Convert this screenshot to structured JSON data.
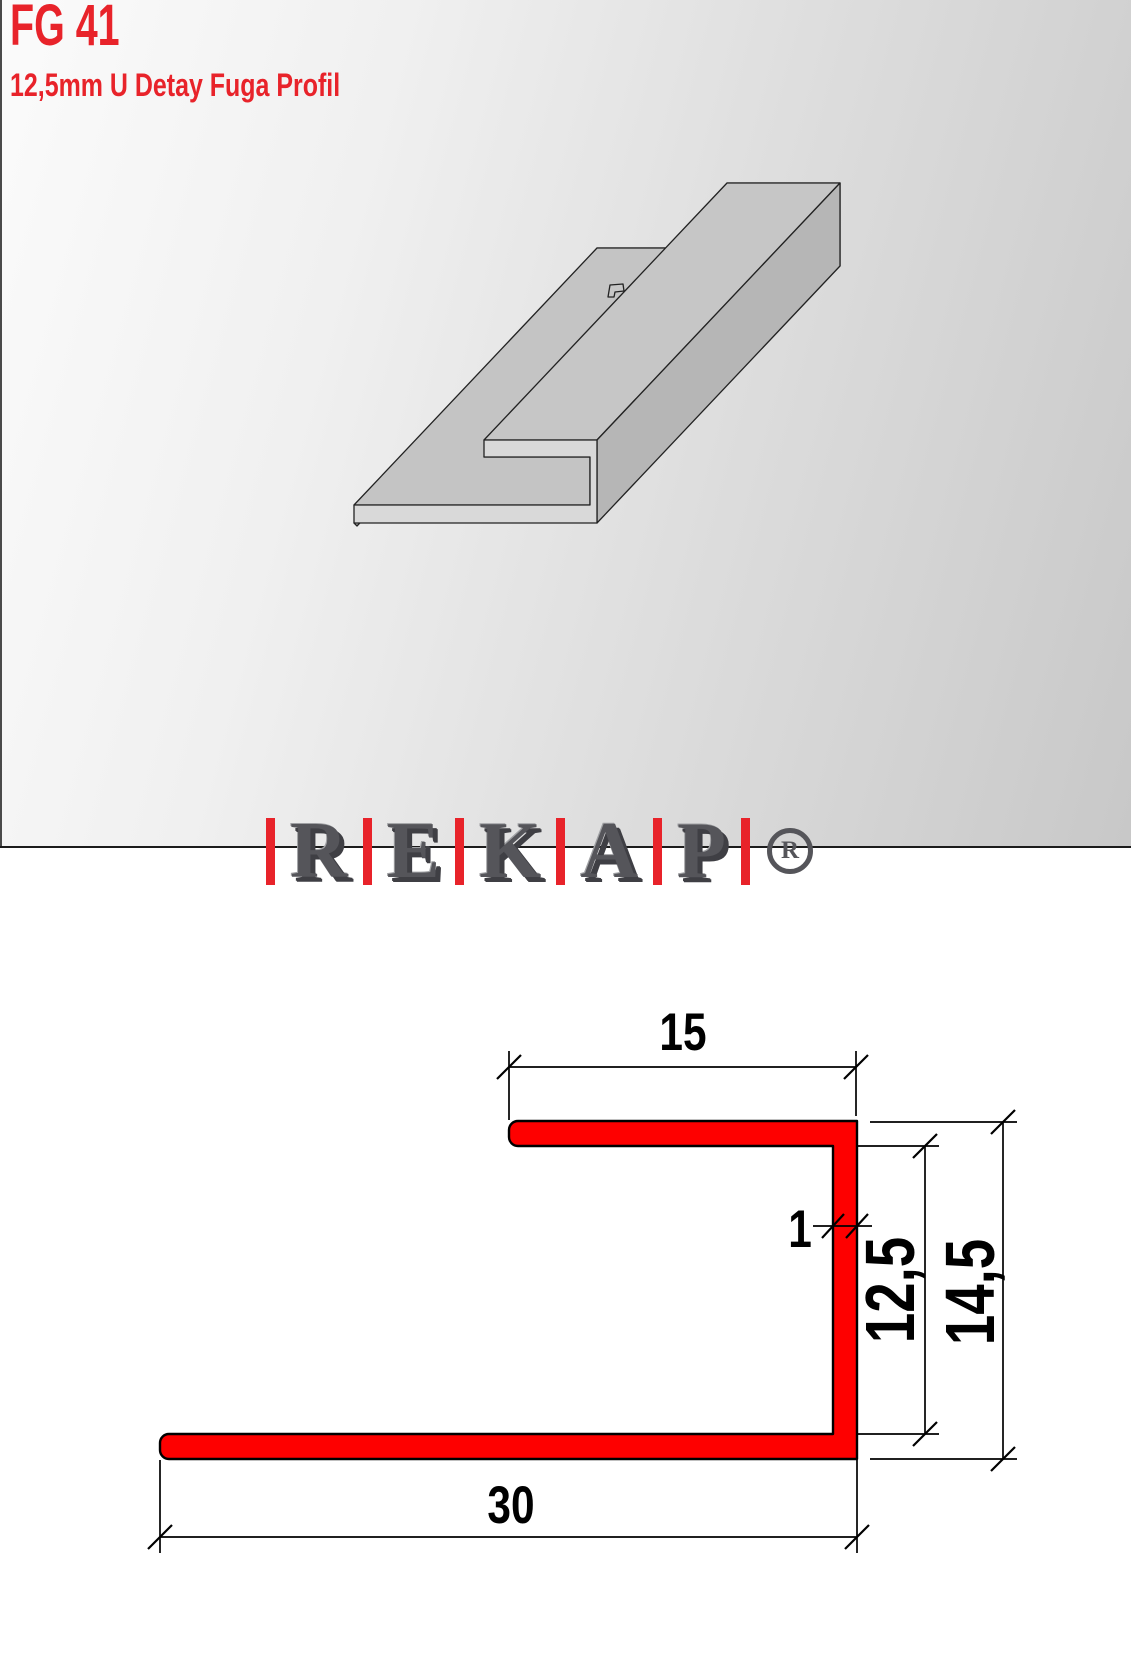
{
  "product": {
    "code": "FG 41",
    "name": "12,5mm U Detay Fuga Profil"
  },
  "brand": {
    "letters": [
      "R",
      "E",
      "K",
      "A",
      "P"
    ],
    "registered": "R"
  },
  "drawing": {
    "dims": {
      "top_flange_width": "15",
      "wall_thickness": "1",
      "inner_height": "12,5",
      "outer_height": "14,5",
      "bottom_flange_width": "30"
    }
  },
  "colors": {
    "accent": "#e8232a",
    "drawing_red": "#fe0000",
    "logo_gray": "#55555a",
    "outline": "#1a1a1a"
  }
}
